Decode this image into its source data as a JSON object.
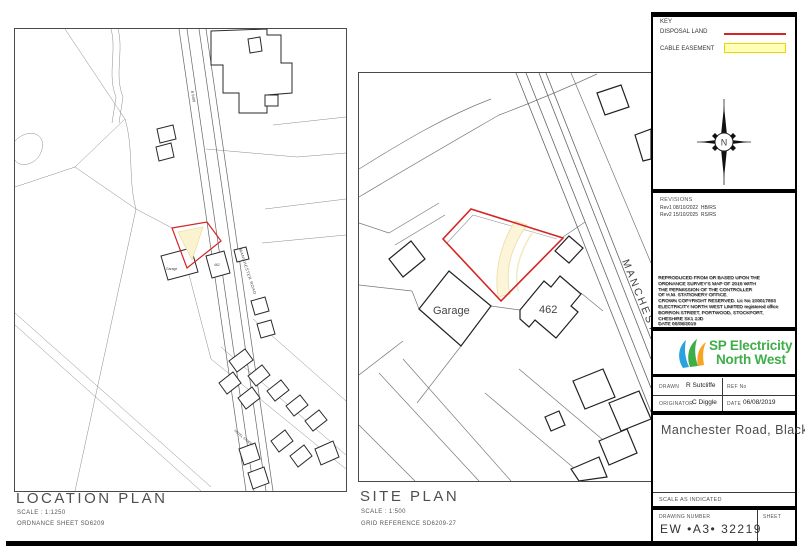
{
  "sheet": {
    "key": {
      "title": "KEY",
      "disposal_label": "DISPOSAL LAND",
      "easement_label": "CABLE EASEMENT"
    },
    "colors": {
      "disposal_red": "#d42525",
      "easement_fill": "#ffffb8",
      "easement_edge": "#e8d900",
      "logo_green": "#3fae49",
      "logo_blue": "#29a3dd",
      "logo_orange": "#f6a522"
    },
    "compass": {
      "north": "N"
    },
    "revisions": {
      "title": "REVISIONS",
      "rows": [
        "Rev1 08/10/2022  HB/RS",
        "Rev2 15/10/2025  RS/RS"
      ]
    },
    "copyright": {
      "lines": [
        "REPRODUCED FROM OR BASED UPON THE",
        "ORDNANCE SURVEY'S MAP OF 2019 WITH",
        "THE PERMISSION OF THE CONTROLLER",
        "OF H.M. STATIONERY OFFICE.",
        "CROWN COPYRIGHT RESERVED. Lic No 100017893",
        "ELECTRICITY NORTH WEST LIMITED registered office",
        "BORRON STREET, PORTWOOD, STOCKPORT,",
        "CHESHIRE SK1 2JD",
        "DATE  06/08/2019"
      ]
    },
    "logo": {
      "line1": "SP Electricity",
      "line2": "North West"
    },
    "credits": {
      "drawn_label": "DRAWN",
      "drawn": "R Sutcliffe",
      "ref_label": "REF No",
      "originator_label": "ORIGINATOR",
      "originator": "C Diggle",
      "date_label": "DATE",
      "date": "06/08/2019"
    },
    "title": "Manchester Road, Blackrod.",
    "scale_note": "SCALE AS INDICATED",
    "number_block": {
      "drawing_number_label": "DRAWING NUMBER",
      "sheet_label": "SHEET",
      "drawing_number": "EW •A3• 32219"
    }
  },
  "location_plan": {
    "title": "LOCATION PLAN",
    "scale": "SCALE : 1:1250",
    "ordnance": "ORDNANCE SHEET SD6209",
    "labels": {
      "garage": "Garage",
      "house": "462",
      "road": "MANCHESTER ROAD",
      "b_road": "B 5408",
      "street": "HOTEL STREET"
    }
  },
  "site_plan": {
    "title": "SITE PLAN",
    "scale": "SCALE : 1:500",
    "grid": "GRID REFERENCE SD6209-27",
    "labels": {
      "garage": "Garage",
      "house": "462",
      "road": "MANCHESTER ROAD"
    }
  }
}
